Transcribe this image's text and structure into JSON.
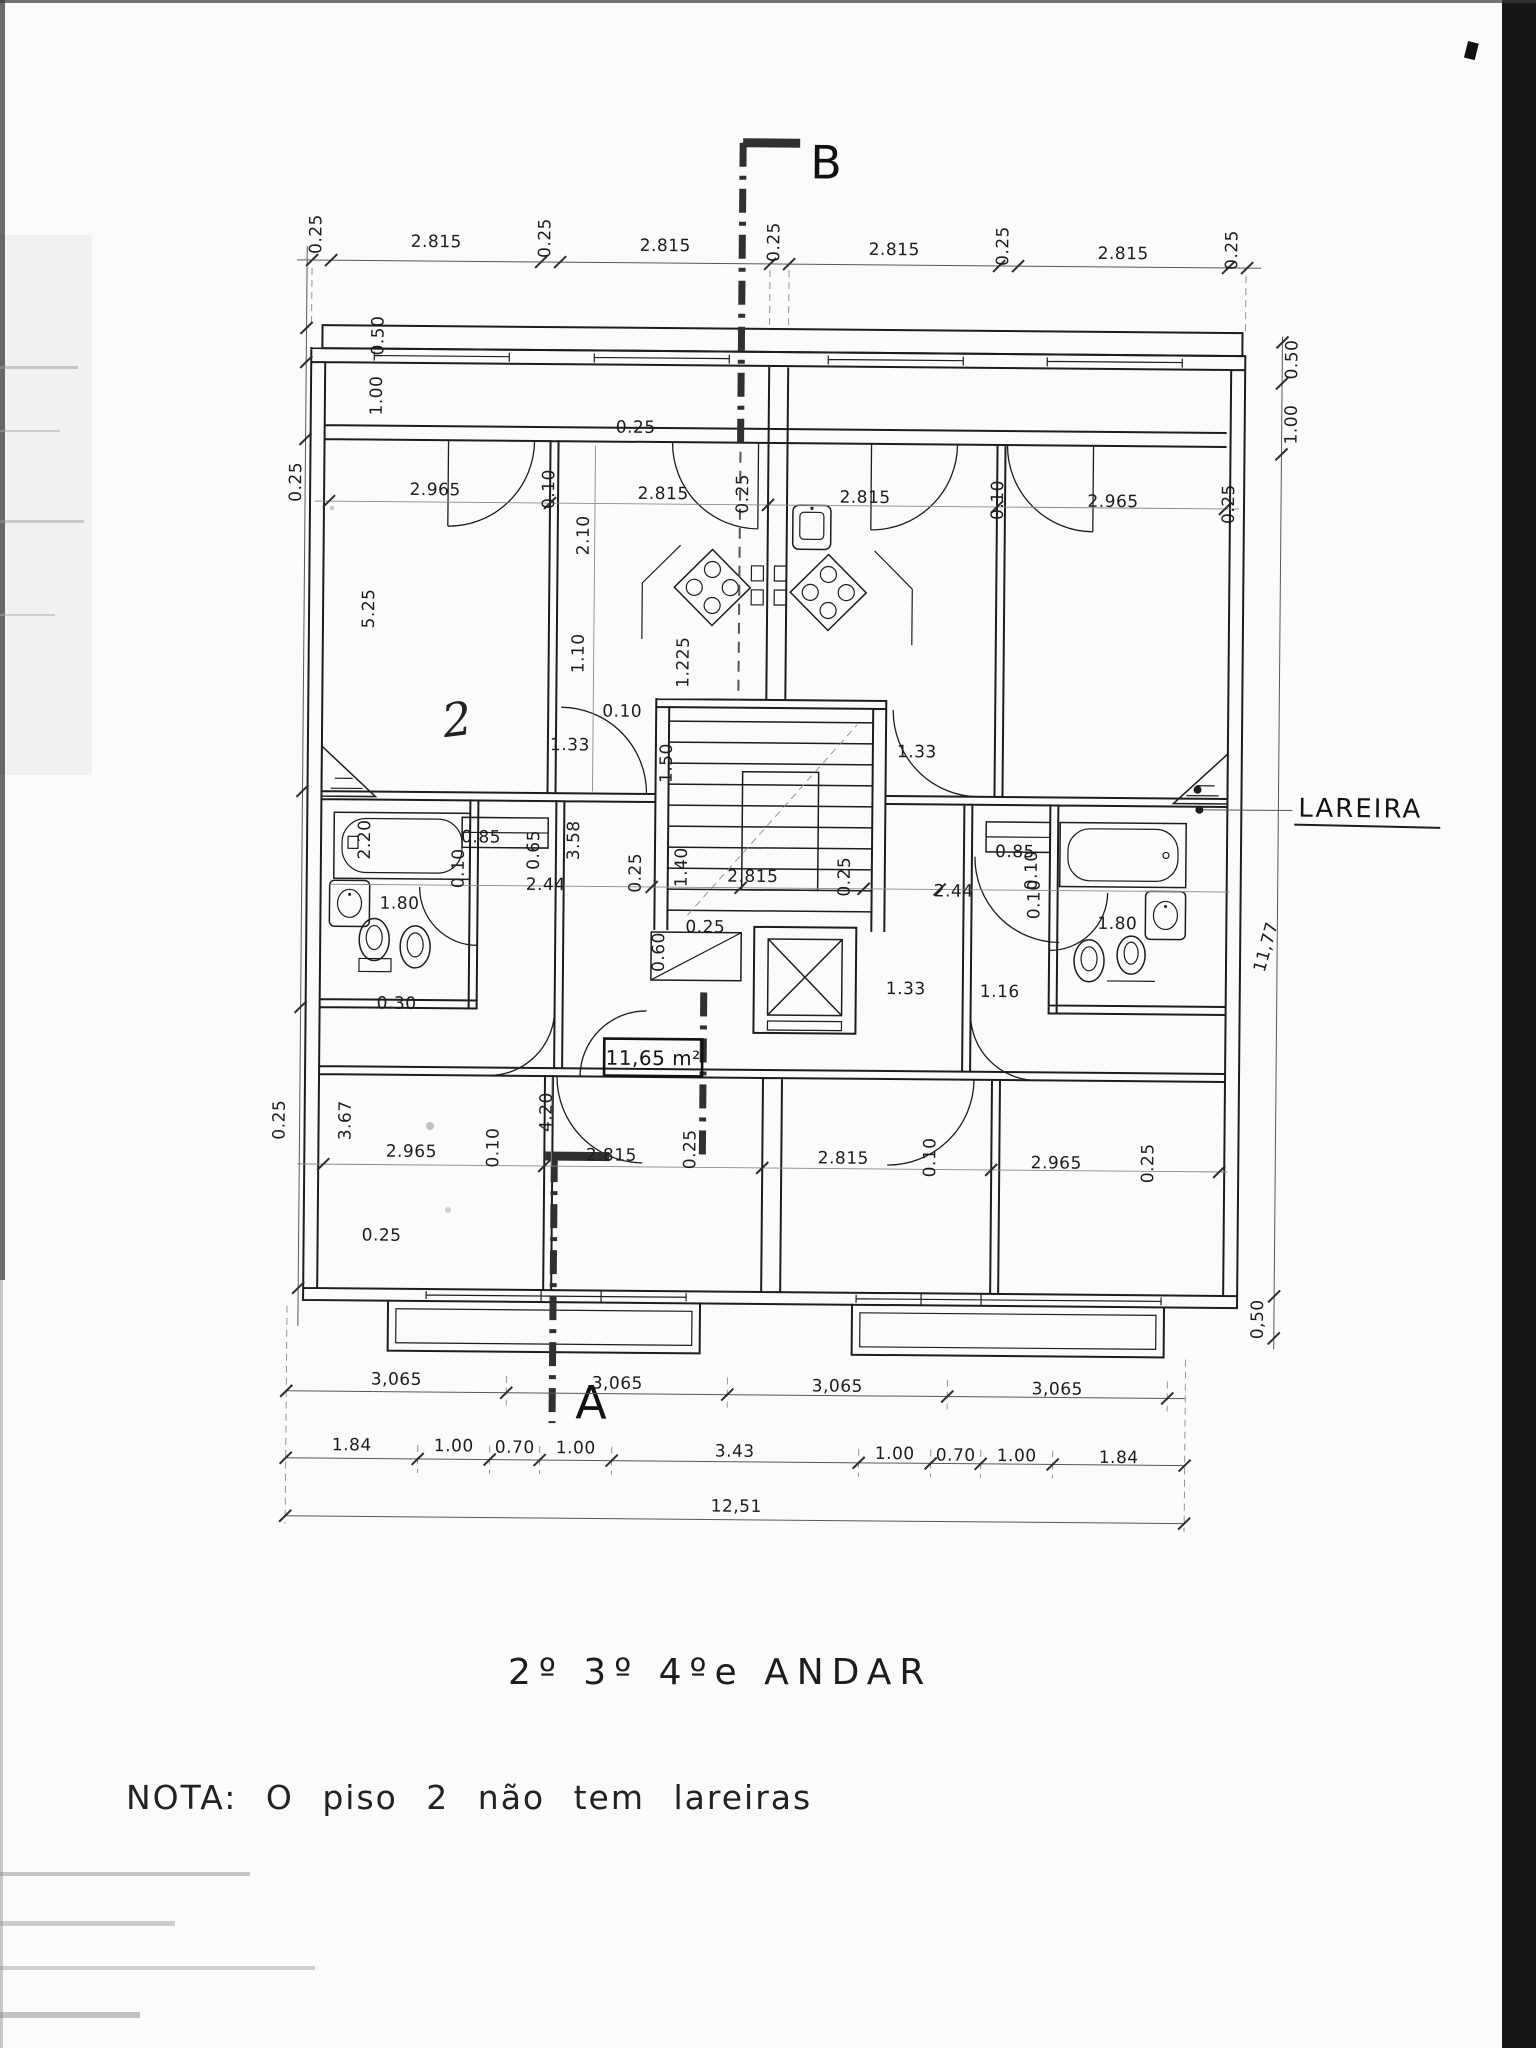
{
  "document": {
    "title": "2º 3º 4ºe ANDAR",
    "note": "NOTA: O piso 2 não tem lareiras",
    "area_box": "11,65 m²",
    "lareira": "LAREIRA",
    "section_top": "B",
    "section_bottom": "A",
    "sketch_mark": "2"
  },
  "dims": {
    "top_chain": [
      "0.25",
      "2.815",
      "0.25",
      "2.815",
      "0.25",
      "2.815",
      "0.25",
      "2.815",
      "0.25"
    ],
    "left_chain": [
      "0.50",
      "1.00",
      "0.25",
      "5.25",
      "2.20",
      "1.80",
      "0.30",
      "3.67",
      "0.25"
    ],
    "right_chain": [
      "0.50",
      "1.00",
      "11,77",
      "0,50"
    ],
    "room_chain_top": [
      "2.965",
      "0.10",
      "2.815",
      "0.25",
      "2.815",
      "0.10",
      "2.965",
      "0.25"
    ],
    "room_chain_bottom": [
      "0.25",
      "2.965",
      "0.10",
      "2.815",
      "0.25",
      "2.815",
      "0.10",
      "2.965",
      "0.25"
    ],
    "vertical_interior": [
      "2.10",
      "1.10",
      "1.225",
      "1.50",
      "4.20"
    ],
    "stair_hall": [
      "0.10",
      "1.33",
      "1.33",
      "0.25",
      "0.25",
      "1.40",
      "2.815",
      "0.25",
      "0.60",
      "0.25",
      "1.33",
      "1.16"
    ],
    "bath_left": [
      "0.85",
      "0.65",
      "2.44",
      "3.58",
      "0.10"
    ],
    "bath_right": [
      "0.85",
      "2.44",
      "0.10",
      "0.10",
      "1.80"
    ],
    "bottom_row1": [
      "3,065",
      "3,065",
      "3,065",
      "3,065"
    ],
    "bottom_row2": [
      "1.84",
      "1.00",
      "0.70",
      "1.00",
      "3.43",
      "1.00",
      "0.70",
      "1.00",
      "1.84"
    ],
    "total_width": "12,51"
  }
}
